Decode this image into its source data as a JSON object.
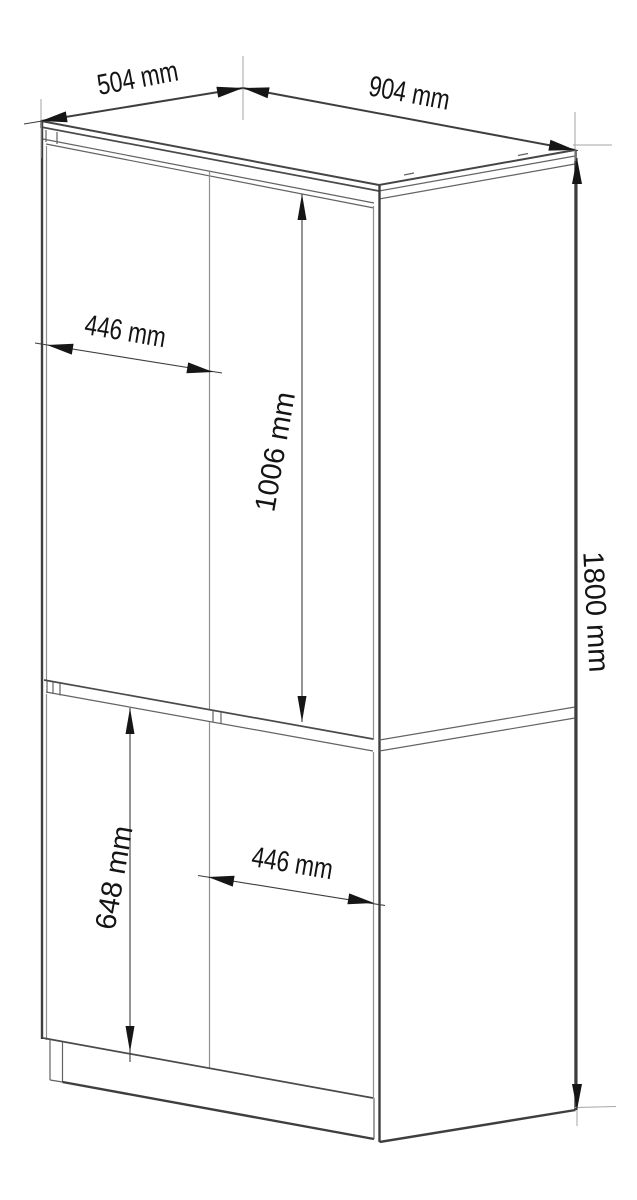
{
  "diagram": {
    "type": "furniture-dimension-drawing",
    "subject": "two-section wardrobe cabinet, isometric view with four doors and plinth",
    "labels": {
      "top_depth": "504 mm",
      "top_width": "904 mm",
      "upper_door_width": "446 mm",
      "upper_door_height": "1006 mm",
      "overall_height": "1800 mm",
      "lower_door_height": "648 mm",
      "lower_door_width": "446 mm"
    },
    "colors": {
      "background": "#ffffff",
      "outline": "#454545",
      "inner_line": "#636363",
      "gap_line": "#8f8f8f",
      "dimension_line": "#3c3c3c",
      "extension_line": "#a6a6a6",
      "arrow": "#161616",
      "text": "#141414"
    }
  }
}
